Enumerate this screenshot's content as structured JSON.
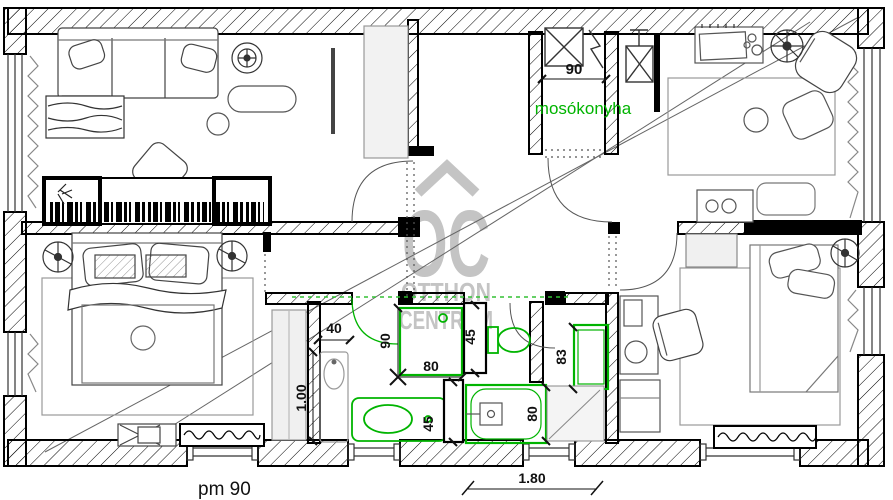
{
  "watermark": {
    "monogram": "OC",
    "word1": "OTTHON",
    "word2": "CENTRUM",
    "color": "#c4c4c4"
  },
  "room_labels": {
    "laundry": "mosókonyha"
  },
  "dimensions": {
    "laundry_opening_width": "90",
    "vanity_depth": "40",
    "vanity_length": "1.00",
    "shower_length": "90",
    "shower_width": "80",
    "cabinet_top": "45",
    "cabinet_bottom": "45",
    "bathtub_width": "80",
    "washbasin_length": "83",
    "window_width": "1.80"
  },
  "notes": {
    "parapet": "pm 90"
  },
  "colors": {
    "fixture_green": "#00b400",
    "dashed_green": "#33c133",
    "wall_black": "#000000",
    "furniture_gray": "#888888",
    "watermark_gray": "#c4c4c4"
  }
}
